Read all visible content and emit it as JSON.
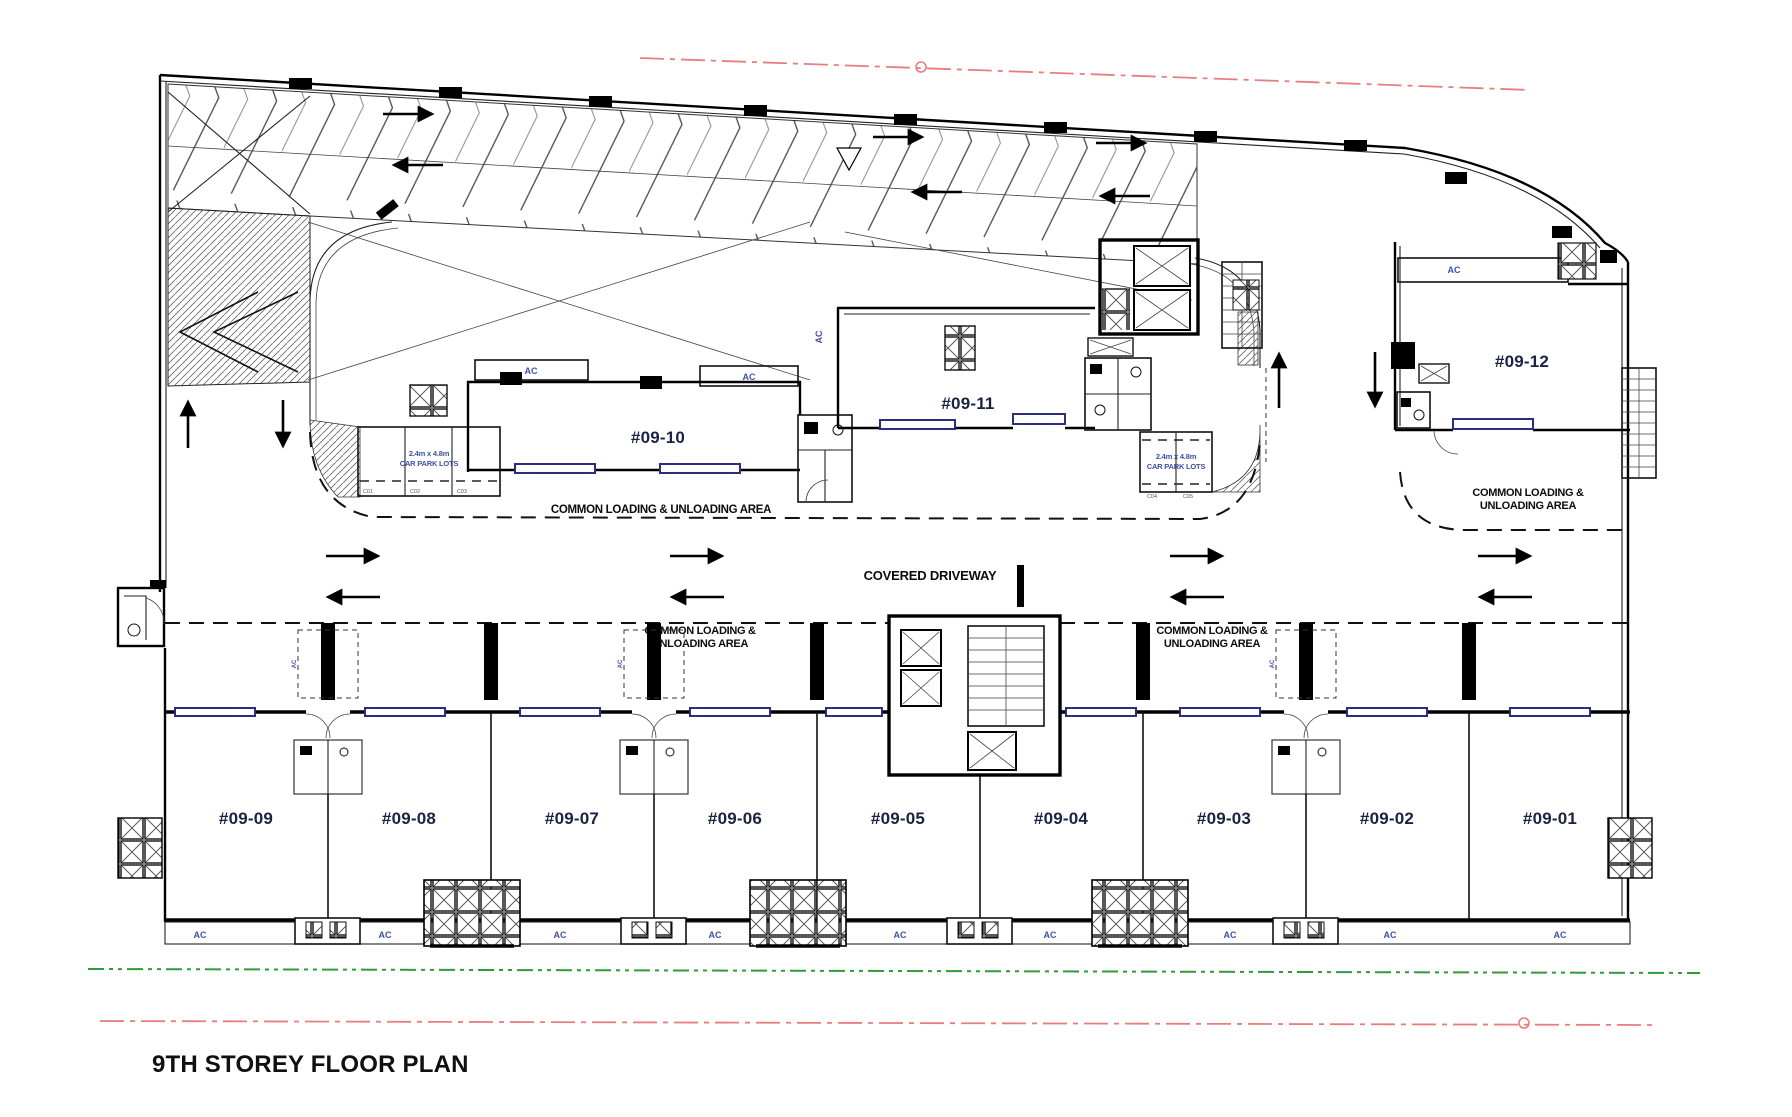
{
  "title": "9TH STOREY FLOOR PLAN",
  "units": {
    "top": [
      "#09-10",
      "#09-11",
      "#09-12"
    ],
    "bottom": [
      "#09-09",
      "#09-08",
      "#09-07",
      "#09-06",
      "#09-05",
      "#09-04",
      "#09-03",
      "#09-02",
      "#09-01"
    ]
  },
  "labels": {
    "covered_driveway": "COVERED DRIVEWAY",
    "loading_single": "COMMON LOADING & UNLOADING AREA",
    "loading_l1": "COMMON LOADING &",
    "loading_l2": "UNLOADING AREA",
    "ac": "AC",
    "carpark_size": "2.4m x 4.8m",
    "carpark_lots": "CAR PARK LOTS",
    "carpark_numbers_left": [
      "C01",
      "C02",
      "C03"
    ],
    "carpark_numbers_right": [
      "C04",
      "C05"
    ]
  },
  "colors": {
    "boundary_red": "#e87d7d",
    "boundary_green": "#2f9b3a",
    "window_navy": "#2b2e7e",
    "small_label_blue": "#3f51a5",
    "ink": "#101010"
  }
}
